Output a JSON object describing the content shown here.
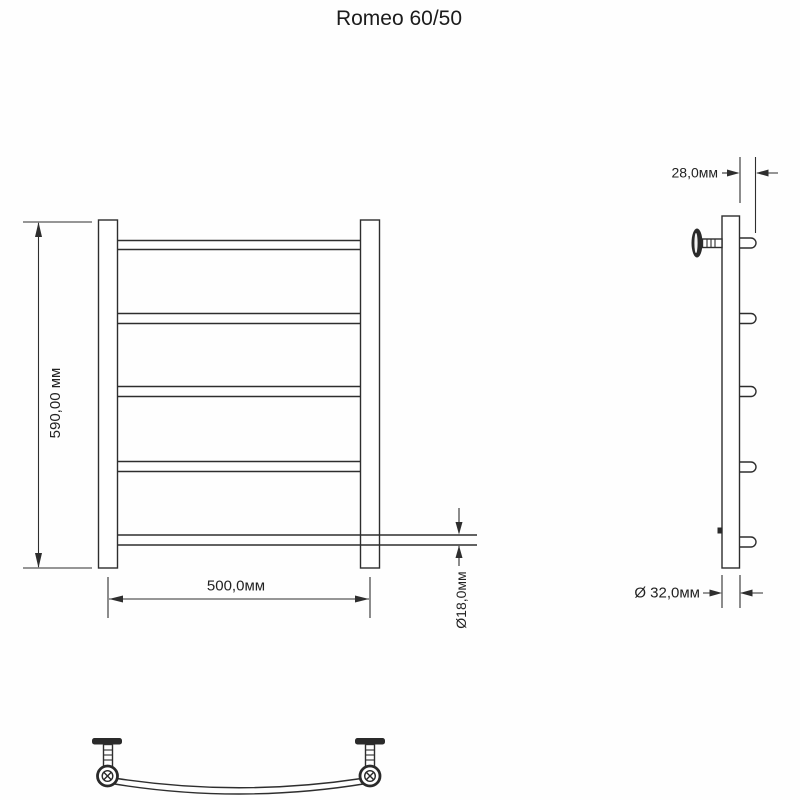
{
  "title": "Romeo 60/50",
  "drawing": {
    "type": "technical-drawing",
    "product": "Romeo 60/50 towel rail",
    "views": {
      "front": {
        "height_label": "590,00 мм",
        "width_label": "500,0мм",
        "rung_diameter_label": "Ø18,0мм",
        "rung_count": 5
      },
      "side": {
        "rung_offset_label": "28,0мм",
        "post_diameter_label": "Ø 32,0мм",
        "rung_count": 5
      },
      "bottom": {
        "bracket_count": 2
      }
    },
    "dimensions_mm": {
      "height": 590.0,
      "width": 500.0,
      "rung_diameter": 18.0,
      "rung_offset": 28.0,
      "post_diameter": 32.0
    }
  }
}
